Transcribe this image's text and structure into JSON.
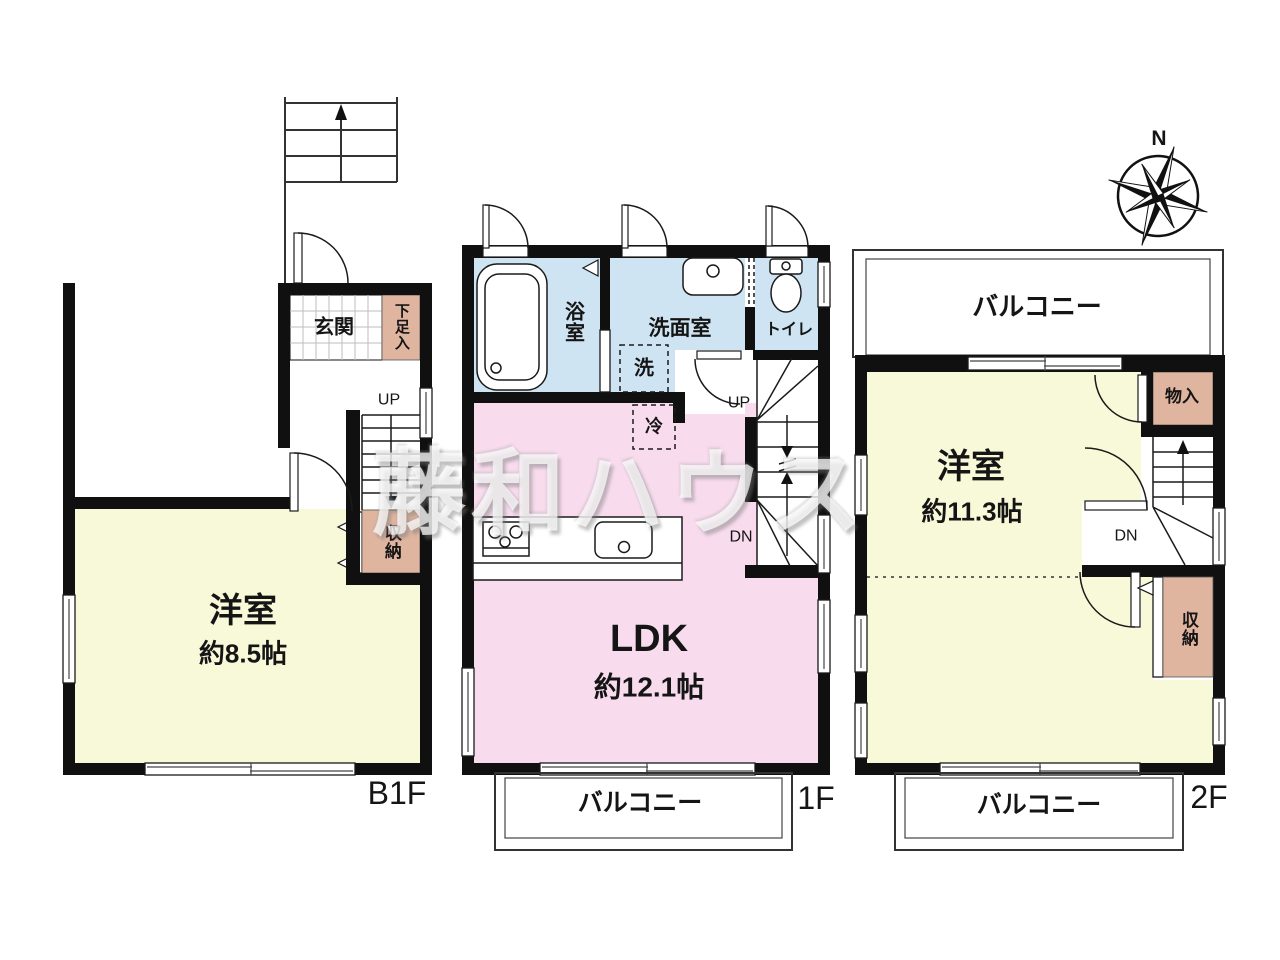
{
  "colors": {
    "wall": "#101010",
    "yellow": "#f8f9d8",
    "blue": "#cfe4f3",
    "pink": "#f8dcee",
    "tan": "#e0b5a0",
    "tile": "#bdbdbd"
  },
  "watermark": {
    "text": "藤和ハウス"
  },
  "compass": {
    "label": "N"
  },
  "b1f": {
    "floor_label": "B1F",
    "entrance": "玄関",
    "shoe_box": "下足入",
    "up": "UP",
    "closet": "収納",
    "room": "洋室",
    "room_size": "約8.5帖"
  },
  "f1": {
    "floor_label": "1F",
    "bath": "浴室",
    "washroom": "洗面室",
    "washer": "洗",
    "fridge": "冷",
    "toilet": "トイレ",
    "up": "UP",
    "down": "DN",
    "ldk": "LDK",
    "ldk_size": "約12.1帖",
    "balcony": "バルコニー"
  },
  "f2": {
    "floor_label": "2F",
    "balcony_top": "バルコニー",
    "room": "洋室",
    "room_size": "約11.3帖",
    "closet": "物入",
    "down": "DN",
    "storage": "収納",
    "balcony_bottom": "バルコニー"
  }
}
